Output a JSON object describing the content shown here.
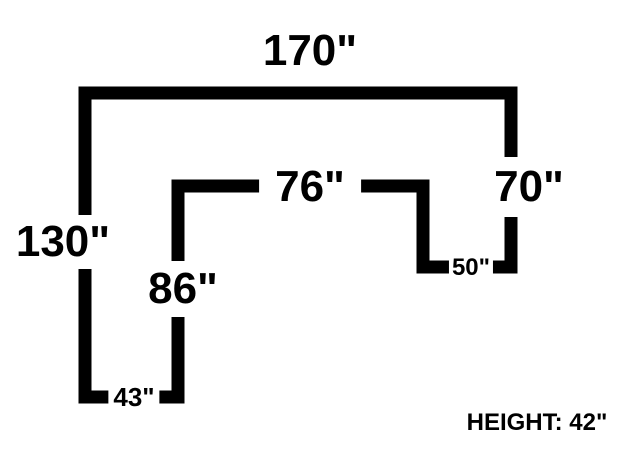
{
  "diagram": {
    "description": "U-shaped counter plan view with dimension labels",
    "colors": {
      "line": "#000000",
      "background": "#ffffff"
    },
    "labels": {
      "top_width": "170\"",
      "right_height": "70\"",
      "left_height": "130\"",
      "inner_width": "76\"",
      "inner_height": "86\"",
      "bottom_left_width": "43\"",
      "bottom_right_width": "50\"",
      "height_note": "HEIGHT: 42\""
    }
  }
}
